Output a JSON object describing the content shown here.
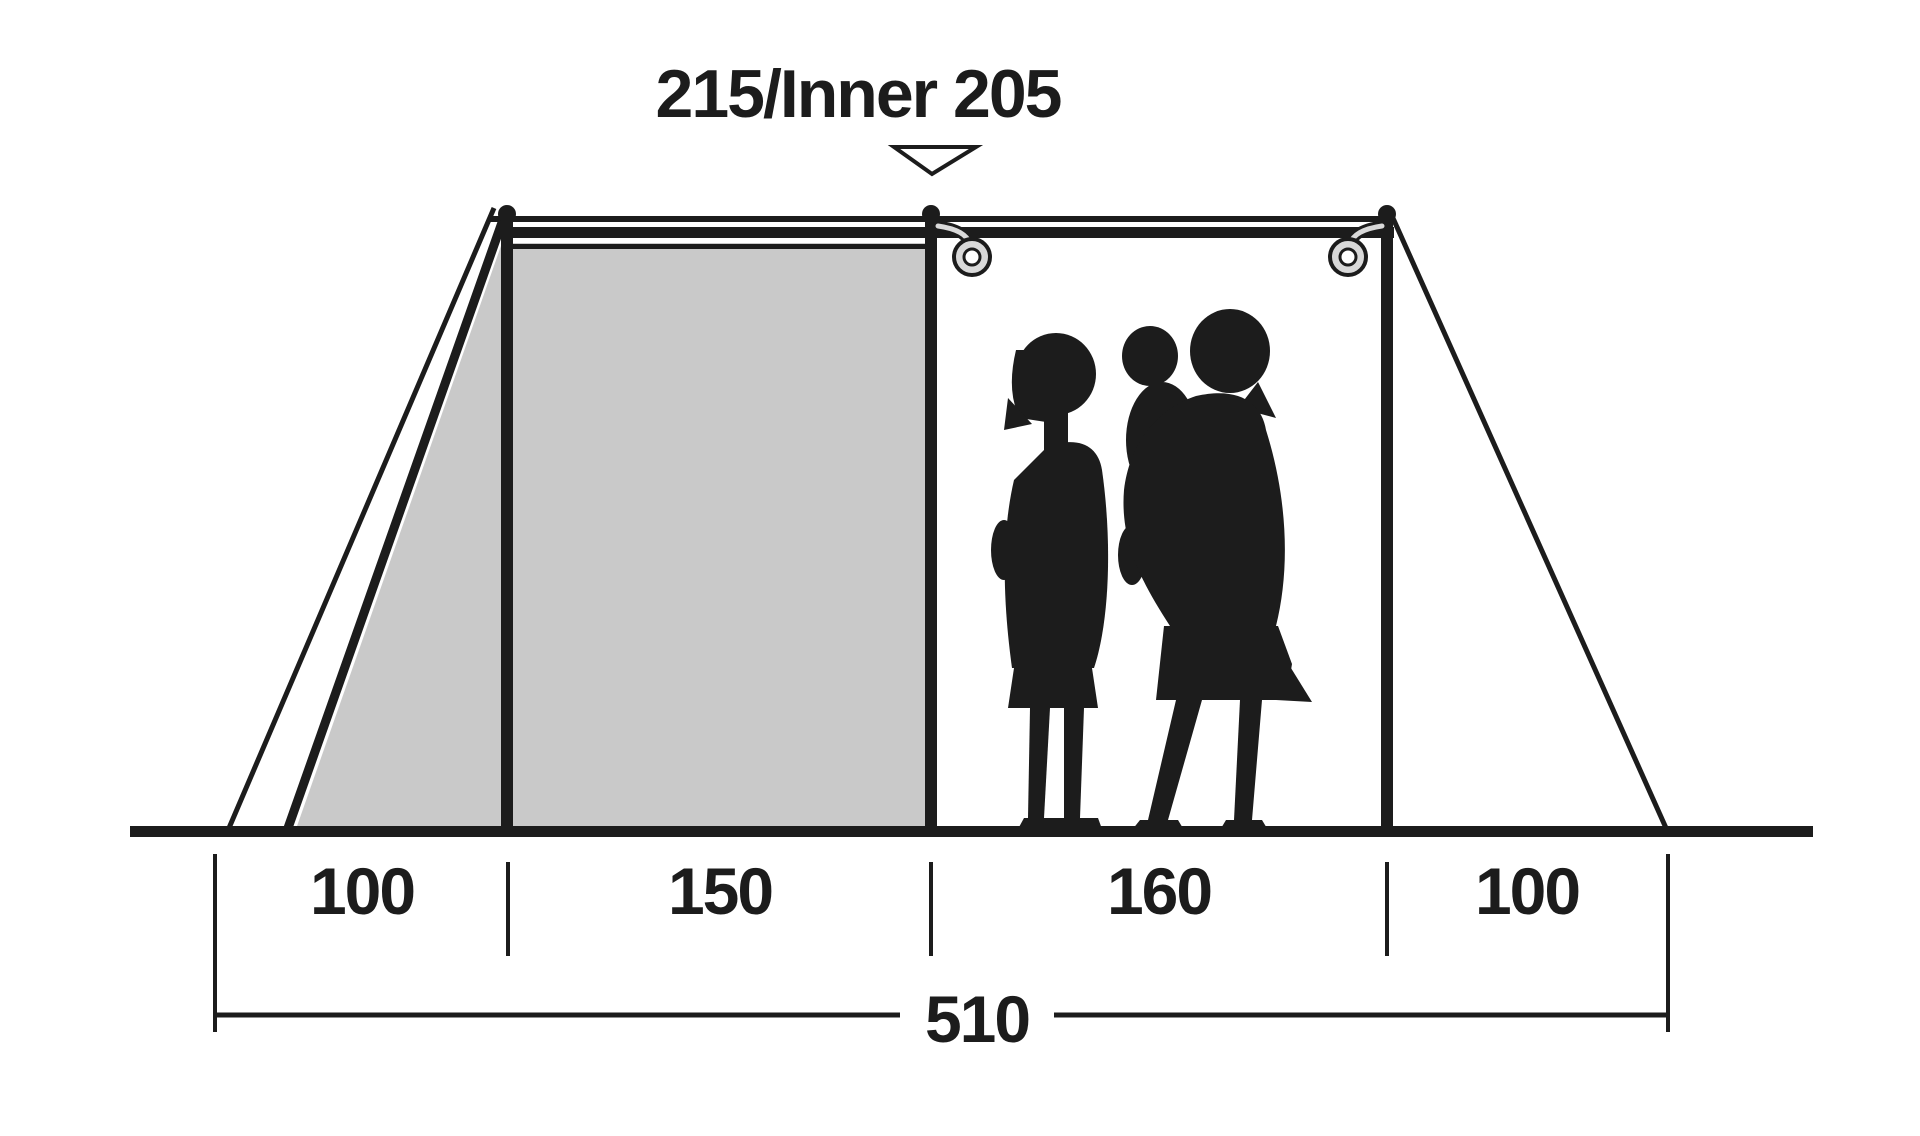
{
  "diagram": {
    "title": "215/Inner 205",
    "bottom_segments": [
      {
        "label": "100"
      },
      {
        "label": "150"
      },
      {
        "label": "160"
      },
      {
        "label": "100"
      }
    ],
    "total_width": "510"
  },
  "colors": {
    "ink": "#1c1c1c",
    "inner_fill": "#c9c9c9",
    "ring_fill": "#d9d9d9",
    "background": "#ffffff"
  }
}
